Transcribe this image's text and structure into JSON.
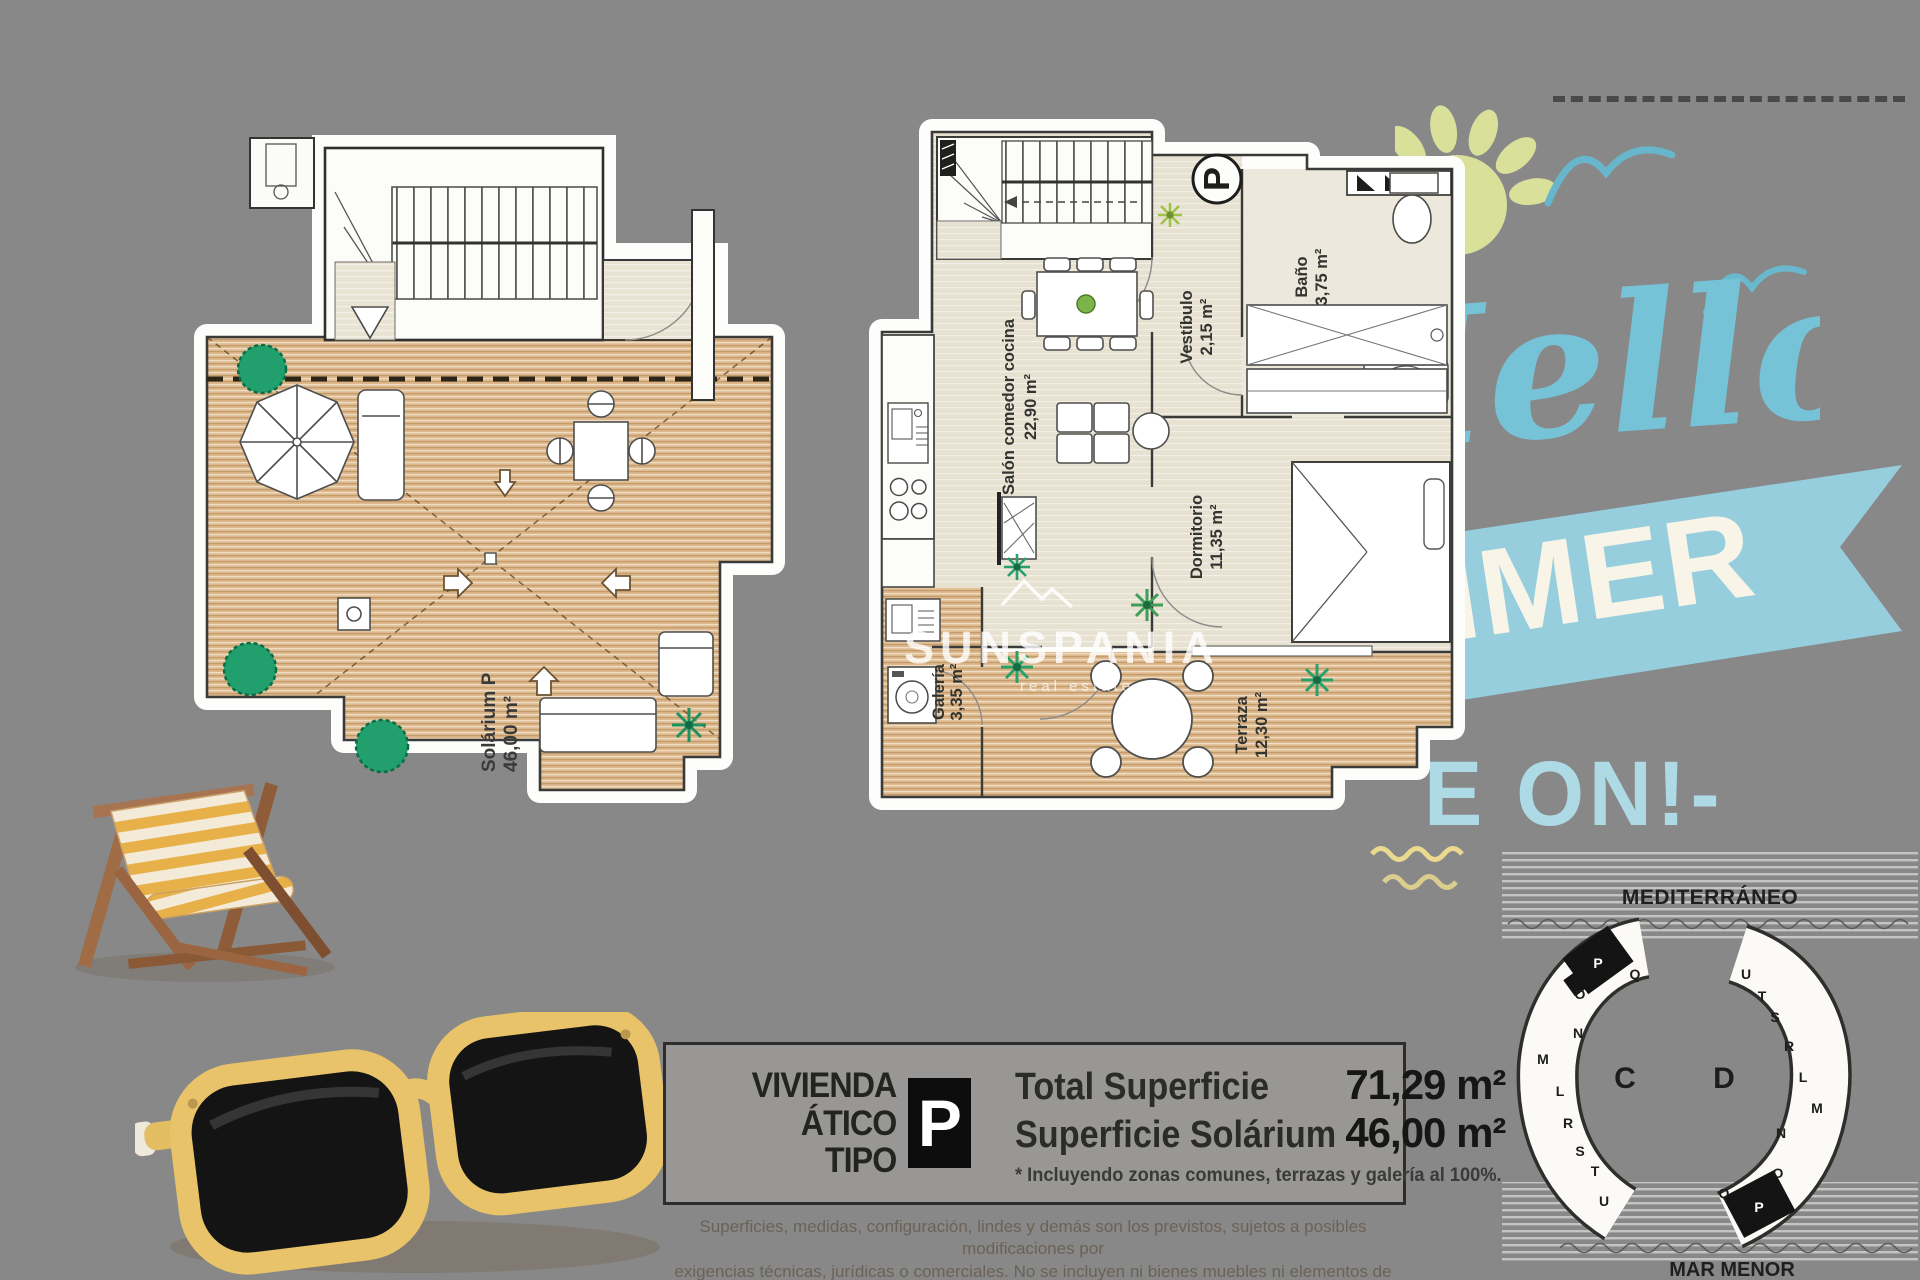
{
  "info_box": {
    "name_line1": "VIVIENDA",
    "name_line2": "ÁTICO TIPO",
    "type_badge": "P",
    "total_label": "Total Superficie",
    "total_value": "71,29 m²",
    "solarium_label": "Superficie Solárium",
    "solarium_value": "46,00 m²",
    "footnote": "* Incluyendo zonas comunes, terrazas y galería al 100%."
  },
  "disclaimer": {
    "line1": "Superficies, medidas, configuración, lindes y demás son los previstos, sujetos a posibles modificaciones por",
    "line2": "exigencias técnicas, jurídicas o comerciales. No se incluyen ni bienes muebles ni elementos de jardinería."
  },
  "summer_graphic": {
    "script_text": "Hello",
    "banner_text": "SUMMER",
    "tagline_text": "E ON!-"
  },
  "plans": {
    "solarium": {
      "label": "Solárium P",
      "area": "46,00 m²"
    },
    "apartment": {
      "badge": "P",
      "vestibulo": {
        "name": "Vestíbulo",
        "area": "2,15 m²"
      },
      "bano": {
        "name": "Baño",
        "area": "3,75 m²"
      },
      "salon": {
        "name": "Salón comedor cocina",
        "area": "22,90 m²"
      },
      "dormitorio": {
        "name": "Dormitorio",
        "area": "11,35 m²"
      },
      "galeria": {
        "name": "Galería",
        "area": "3,35 m²"
      },
      "terraza": {
        "name": "Terraza",
        "area": "12,30 m²"
      },
      "watermark_brand": "SUNSPANIA",
      "watermark_sub": "real estate"
    }
  },
  "site_map": {
    "sea_top": "MEDITERRÁNEO",
    "sea_bottom": "MAR MENOR",
    "block_c_label": "C",
    "block_d_label": "D",
    "c_units": [
      "P",
      "Q",
      "O",
      "N",
      "M",
      "L",
      "R",
      "S",
      "T",
      "U"
    ],
    "d_units": [
      "U",
      "T",
      "S",
      "R",
      "L",
      "M",
      "N",
      "O",
      "Q",
      "P"
    ],
    "highlight_unit": "P"
  },
  "colors": {
    "accent_blue": "#76c3d7",
    "banner_blue": "#96cedd",
    "sun_yellow": "#d9e099",
    "deck_tan": "#ddb98c",
    "sand": "#e4ccab",
    "highlight_black": "#141414"
  }
}
